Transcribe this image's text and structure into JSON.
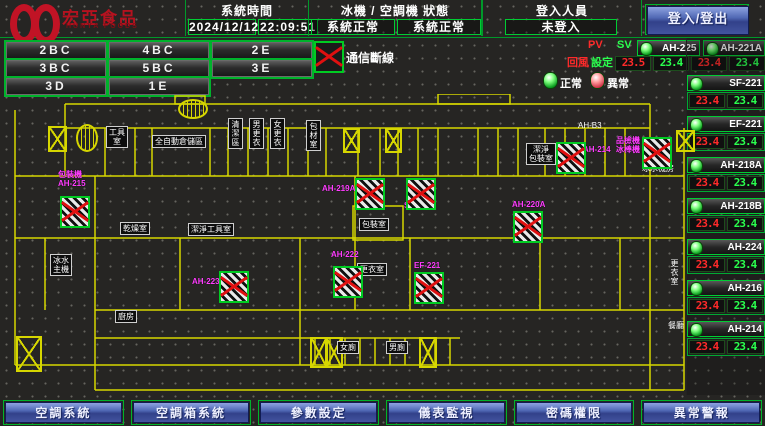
{
  "header": {
    "logo": {
      "brand": "宏亞食品",
      "brand_sub": "HUNYA FOODS"
    },
    "system_time": {
      "label": "系統時間",
      "date": "2024/12/12",
      "time": "22:09:51"
    },
    "machine_status": {
      "label": "冰機 / 空調機 狀態",
      "chiller_status": "系統正常",
      "ac_status": "系統正常"
    },
    "login": {
      "label": "登入人員",
      "value": "未登入",
      "button": "登入/登出"
    }
  },
  "zone_buttons": [
    "2BC",
    "4BC",
    "2E",
    "3BC",
    "5BC",
    "3E",
    "3D",
    "1E"
  ],
  "legend": {
    "comm_loss": "通信斷線",
    "normal": "正常",
    "abnormal": "異常",
    "pv": "PV",
    "sv": "SV",
    "row_pv": "回風",
    "row_sv": "設定"
  },
  "colors": {
    "accent_green": "#00cc33",
    "alarm_red": "#e01010",
    "wall_yellow": "#d6d600",
    "device_magenta": "#ff3dff",
    "pv_red": "#ff2a2a",
    "sv_green": "#2aff4e"
  },
  "devices_panel": {
    "top_pair": [
      {
        "name": "AH-225",
        "pv": "23.5",
        "sv": "23.4"
      },
      {
        "name": "AH-221A",
        "pv": "23.4",
        "sv": "23.4"
      }
    ],
    "units": [
      {
        "name": "SF-221",
        "pv": "23.4",
        "sv": "23.4"
      },
      {
        "name": "EF-221",
        "pv": "23.4",
        "sv": "23.4"
      },
      {
        "name": "AH-218A",
        "pv": "23.4",
        "sv": "23.4"
      },
      {
        "name": "AH-218B",
        "pv": "23.4",
        "sv": "23.4"
      },
      {
        "name": "AH-224",
        "pv": "23.4",
        "sv": "23.4"
      },
      {
        "name": "AH-216",
        "pv": "23.4",
        "sv": "23.4"
      },
      {
        "name": "AH-214",
        "pv": "23.4",
        "sv": "23.4"
      }
    ]
  },
  "floor_plan": {
    "rooms": [
      {
        "t": "工具\n室",
        "x": 106,
        "y": 126
      },
      {
        "t": "全自動倉儲區",
        "x": 152,
        "y": 135
      },
      {
        "t": "清潔區",
        "x": 228,
        "y": 118,
        "v": 1
      },
      {
        "t": "男更衣",
        "x": 249,
        "y": 118,
        "v": 1
      },
      {
        "t": "女更衣",
        "x": 270,
        "y": 118,
        "v": 1
      },
      {
        "t": "包材室",
        "x": 306,
        "y": 120,
        "v": 1
      },
      {
        "t": "AH-B3",
        "x": 576,
        "y": 120,
        "nb": 1
      },
      {
        "t": "潔淨\n包裝室",
        "x": 526,
        "y": 143
      },
      {
        "t": "冰水機房",
        "x": 640,
        "y": 163,
        "nb": 1
      },
      {
        "t": "乾燥室",
        "x": 120,
        "y": 222
      },
      {
        "t": "潔淨工具室",
        "x": 188,
        "y": 223
      },
      {
        "t": "包裝室",
        "x": 359,
        "y": 218
      },
      {
        "t": "更衣室",
        "x": 357,
        "y": 263
      },
      {
        "t": "冰水\n主機",
        "x": 50,
        "y": 254
      },
      {
        "t": "廚房",
        "x": 115,
        "y": 310
      },
      {
        "t": "女廁",
        "x": 337,
        "y": 341
      },
      {
        "t": "男廁",
        "x": 386,
        "y": 341
      },
      {
        "t": "更衣室",
        "x": 668,
        "y": 258,
        "v": 1,
        "nb": 1
      },
      {
        "t": "餐廳",
        "x": 666,
        "y": 320,
        "nb": 1
      }
    ],
    "device_labels": [
      {
        "t": "包裝機\nAH-215",
        "x": 58,
        "y": 170
      },
      {
        "t": "AH-219A",
        "x": 322,
        "y": 184
      },
      {
        "t": "SF-221",
        "x": 404,
        "y": 201
      },
      {
        "t": "AH-220A",
        "x": 512,
        "y": 200
      },
      {
        "t": "EF-221",
        "x": 414,
        "y": 261
      },
      {
        "t": "AH-214",
        "x": 583,
        "y": 145
      },
      {
        "t": "品檢機\n冰棒機",
        "x": 616,
        "y": 136
      },
      {
        "t": "AH-223",
        "x": 192,
        "y": 277
      },
      {
        "t": "AH-222",
        "x": 331,
        "y": 250
      }
    ],
    "devices": [
      {
        "x": 60,
        "y": 196
      },
      {
        "x": 355,
        "y": 178
      },
      {
        "x": 406,
        "y": 178
      },
      {
        "x": 513,
        "y": 211
      },
      {
        "x": 414,
        "y": 272
      },
      {
        "x": 556,
        "y": 142
      },
      {
        "x": 642,
        "y": 137
      },
      {
        "x": 219,
        "y": 271
      },
      {
        "x": 333,
        "y": 266
      }
    ]
  },
  "nav_buttons": [
    "空調系統",
    "空調箱系統",
    "參數設定",
    "儀表監視",
    "密碼權限",
    "異常警報"
  ]
}
